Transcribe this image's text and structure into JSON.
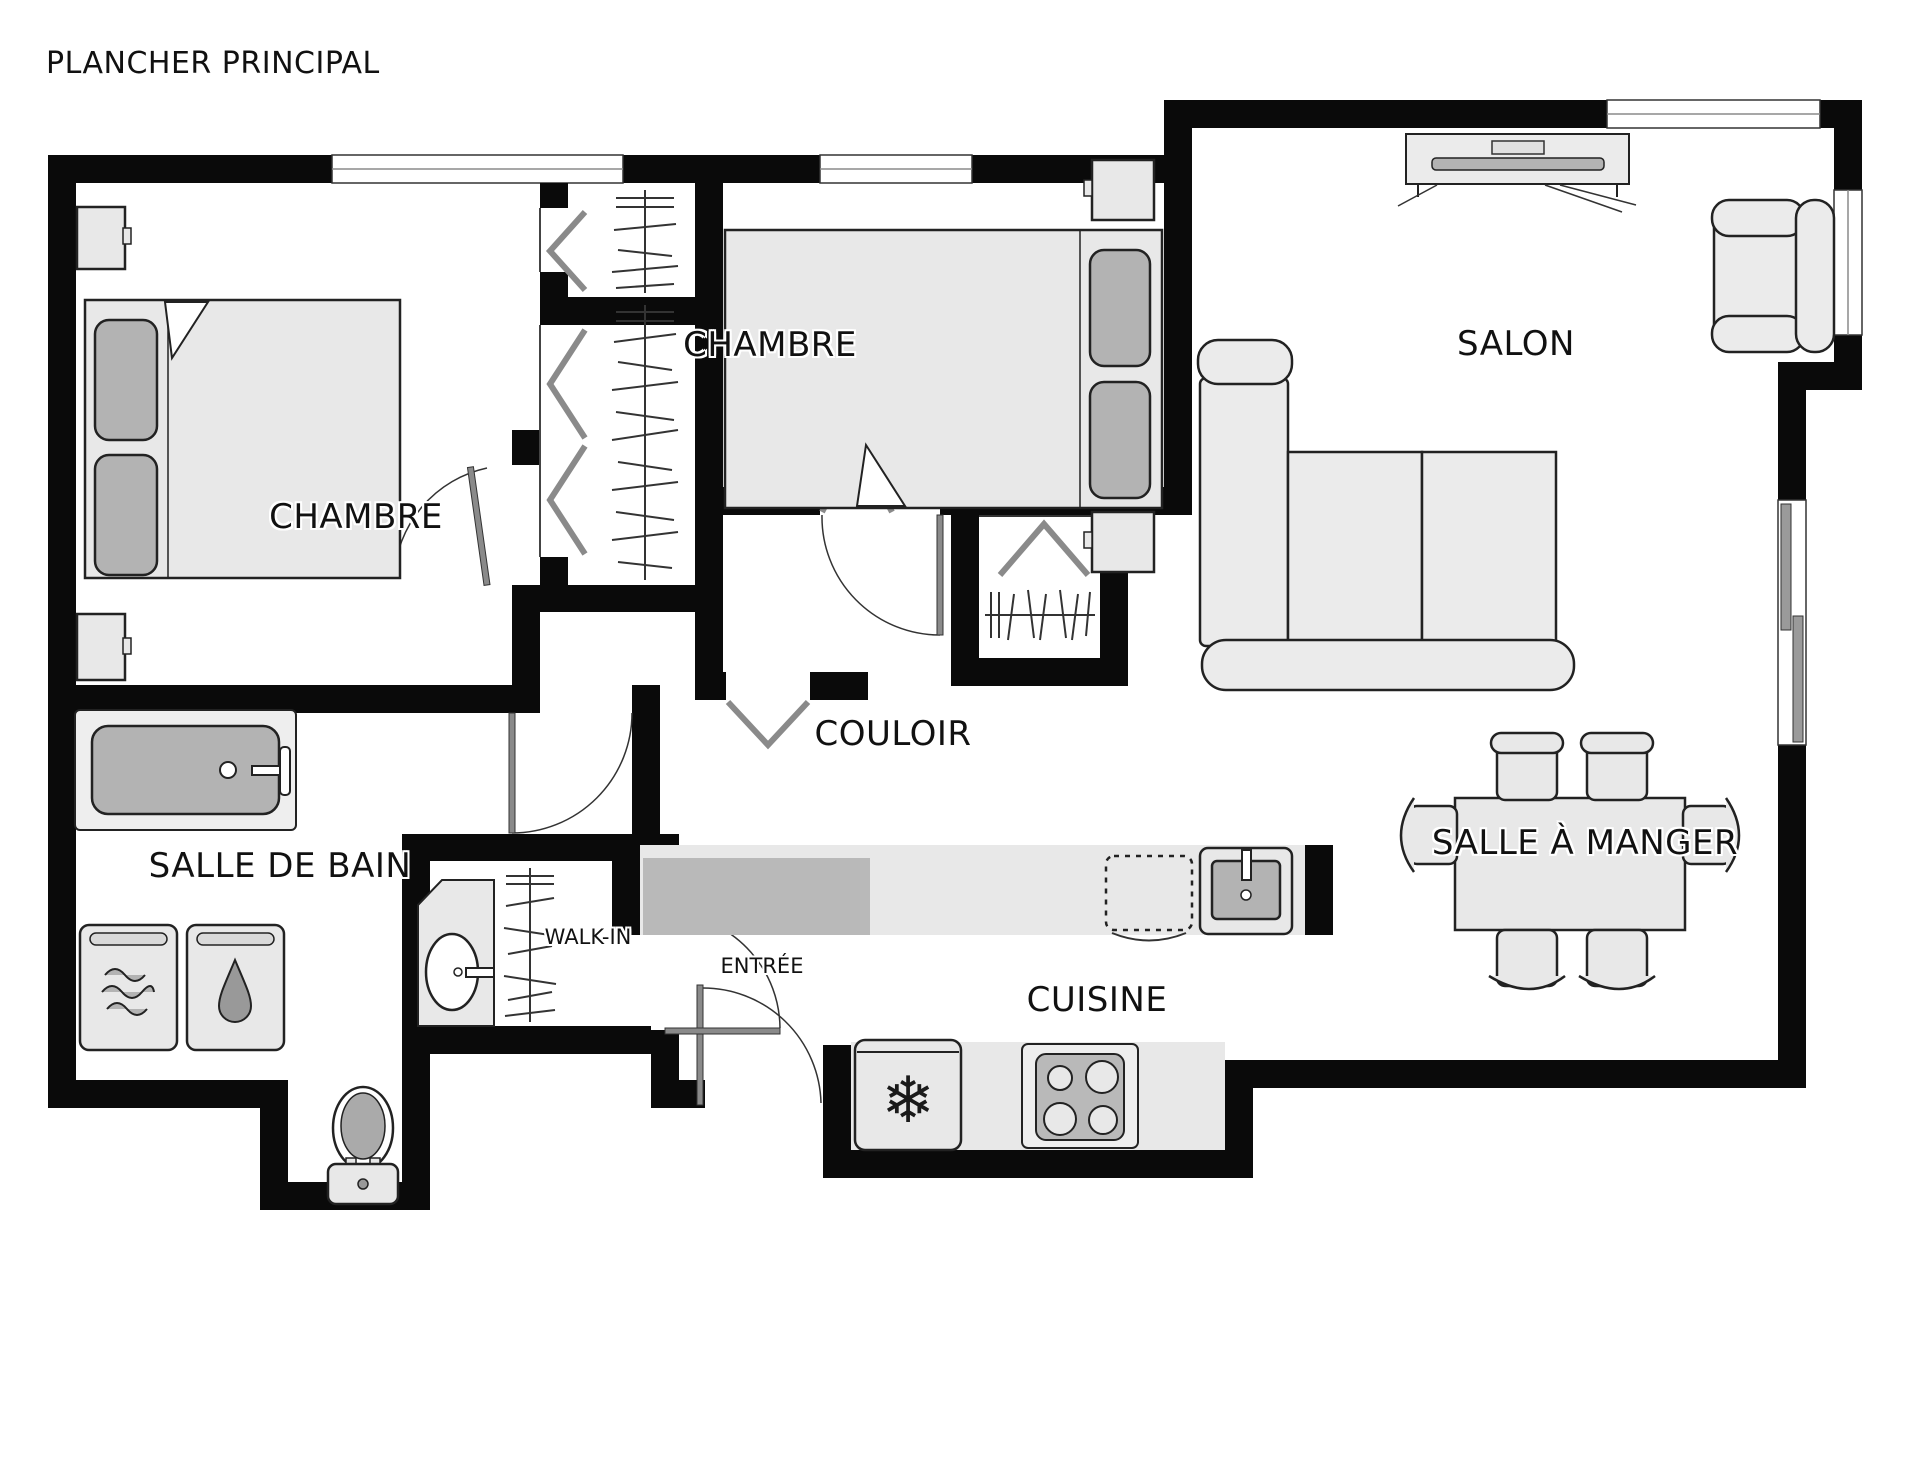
{
  "title": "PLANCHER PRINCIPAL",
  "rooms": {
    "bedroom1": {
      "label": "CHAMBRE"
    },
    "bedroom2": {
      "label": "CHAMBRE"
    },
    "living": {
      "label": "SALON"
    },
    "hallway": {
      "label": "COULOIR"
    },
    "bathroom": {
      "label": "SALLE DE BAIN"
    },
    "walkin": {
      "label": "WALK-IN"
    },
    "entry": {
      "label": "ENTRÉE"
    },
    "kitchen": {
      "label": "CUISINE"
    },
    "dining": {
      "label": "SALLE À MANGER"
    }
  },
  "icons": {
    "snowflake": "❄"
  },
  "furniture": [
    "double-bed",
    "nightstand",
    "closet-rod",
    "bifold-door",
    "tv-console",
    "armchair",
    "sectional-sofa",
    "dining-table",
    "dining-chair",
    "bathtub",
    "washer",
    "dryer",
    "toilet",
    "vanity-sink",
    "kitchen-sink",
    "dishwasher",
    "refrigerator",
    "stove"
  ],
  "colors": {
    "wall": "#0a0a0a",
    "furniture_light": "#ebebeb",
    "furniture_mid": "#b3b3b3",
    "furniture_dark": "#999999",
    "door_leaf": "#8a8a8a",
    "line": "#222222"
  }
}
